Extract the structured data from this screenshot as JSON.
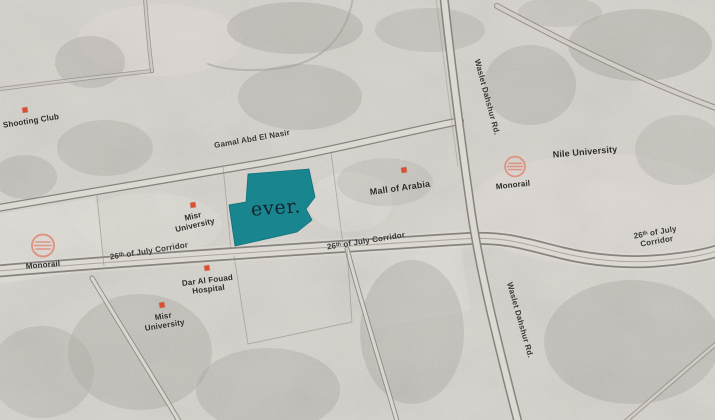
{
  "brand": {
    "site_label": "ever."
  },
  "map": {
    "labels": {
      "shooting_club": "Shooting Club",
      "gamal_road": "Gamal Abd El Nasir",
      "misr_university_upper": "Misr\nUniversity",
      "corridor_left": "26ᵗʰ of July Corridor",
      "corridor_middle": "26ᵗʰ of July Corridor",
      "corridor_right": "26ᵗʰ of July Corridor",
      "mall_of_arabia": "Mall of Arabia",
      "monorail_left": "Monorail",
      "monorail_right": "Monorail",
      "nile_university": "Nile University",
      "waslet_top": "Waslet Dahshur Rd.",
      "waslet_bottom": "Waslet Dahshur Rd.",
      "dar_al_fouad": "Dar Al Fouad\nHospital",
      "misr_university_lower": "Misr\nUniversity"
    },
    "colors": {
      "site_fill": "#19858E",
      "site_text": "#14222C",
      "poi_marker": "#DD4F2E",
      "monorail_icon": "#E07258",
      "label_text": "#2C2C2C",
      "map_background": "#D7D3CD",
      "road_fill": "#DCD8D2",
      "road_edge": "#87837E"
    }
  }
}
